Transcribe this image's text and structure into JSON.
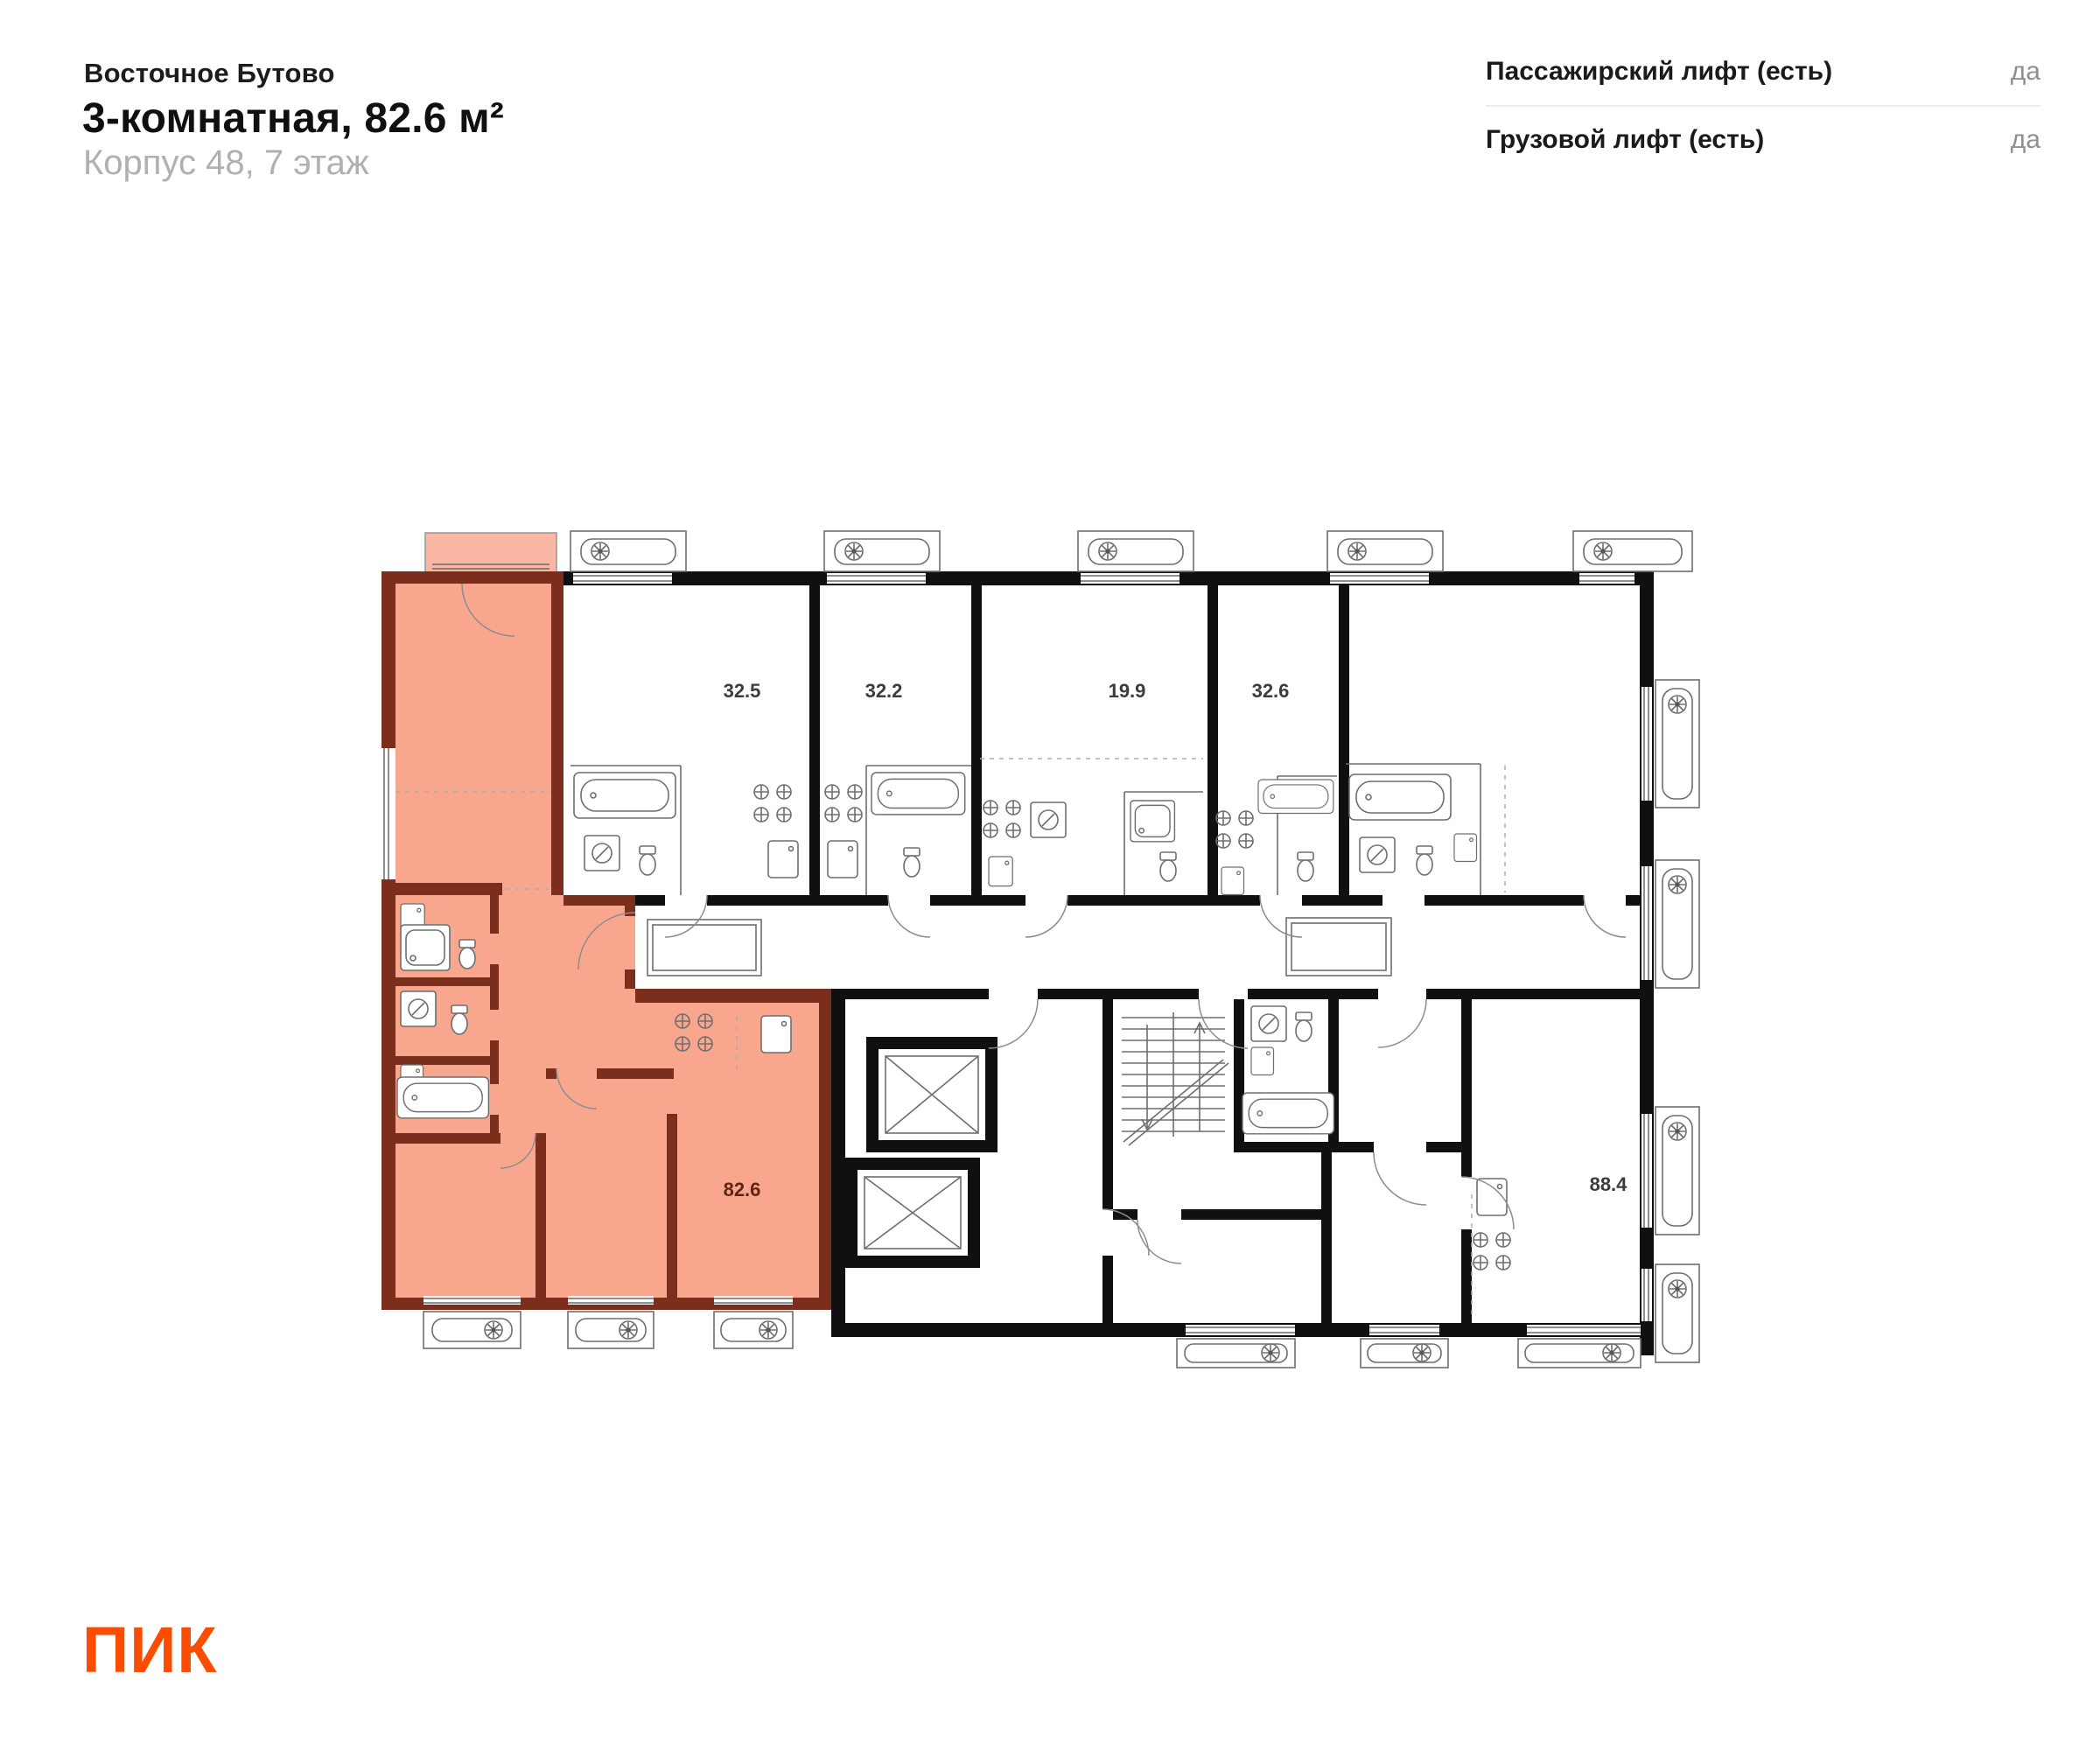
{
  "header": {
    "project_name": "Восточное Бутово",
    "title": "3-комнатная, 82.6 м²",
    "subtitle": "Корпус 48, 7 этаж"
  },
  "amenities": {
    "rows": [
      {
        "label": "Пассажирский лифт (есть)",
        "value": "да"
      },
      {
        "label": "Грузовой лифт (есть)",
        "value": "да"
      }
    ]
  },
  "floorplan": {
    "highlight_color": "#f8a68e",
    "highlight_wall_color": "#7b2e1c",
    "labels": {
      "unit_325": "32.5",
      "unit_322": "32.2",
      "unit_199": "19.9",
      "unit_326": "32.6",
      "highlighted_unit": "82.6",
      "unit_884": "88.4"
    }
  },
  "logo": {
    "text": "ПИК",
    "color": "#fc4c02"
  }
}
